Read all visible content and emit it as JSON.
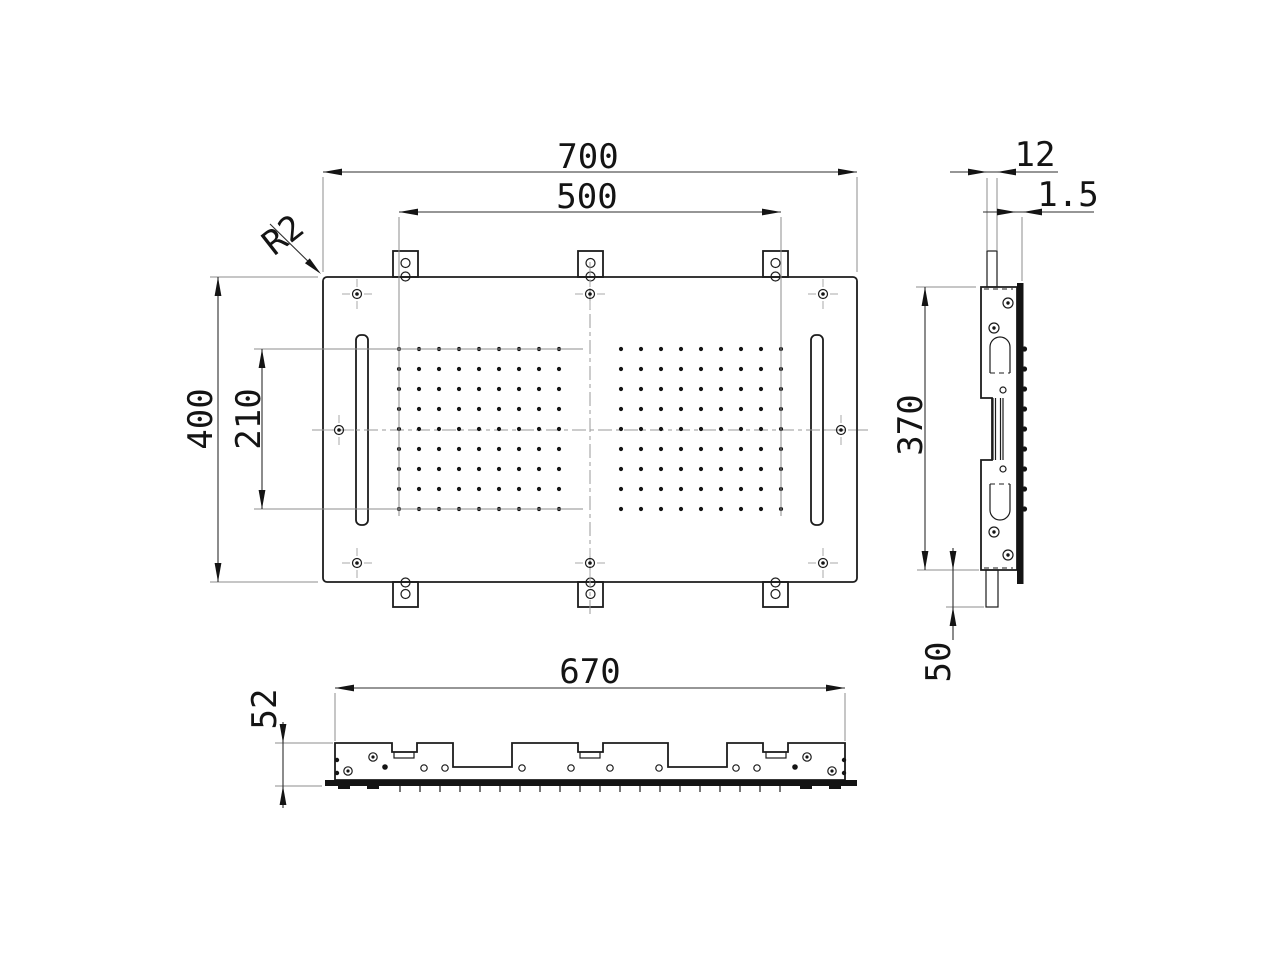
{
  "page": {
    "background": "#ffffff",
    "line_color": "#1c1c1c",
    "dim_color": "#2e2e2e"
  },
  "drawing": {
    "labels": {
      "overall_width": "700",
      "hole_field_width": "500",
      "overall_height": "400",
      "hole_field_height": "210",
      "corner_radius": "R2",
      "side_tab_width": "12",
      "side_plate_thickness": "1.5",
      "side_height": "370",
      "side_hook_length": "50",
      "front_width": "670",
      "front_depth": "52"
    }
  }
}
